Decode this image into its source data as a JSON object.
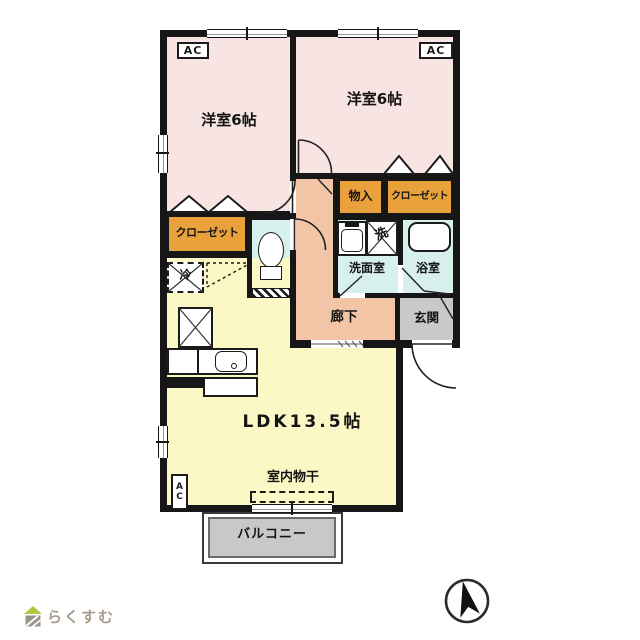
{
  "palette": {
    "wall": "#161616",
    "bedroom_pink": "#f8e4e2",
    "closet_orange": "#e9a13b",
    "water_cyan": "#d7f0ee",
    "ldk_yellow": "#fbf8c5",
    "hall_salmon": "#f3c5a7",
    "entrance_gray": "#c9c9c9",
    "balcony_gray": "#c8c8c8",
    "logo_text_gray": "#a79a8d",
    "logo_roof_green": "#b3c83f"
  },
  "rooms": {
    "bedroom1": "洋室6帖",
    "bedroom2": "洋室6帖",
    "storage": "物入",
    "closet_right": "クローゼット",
    "closet_left": "クローゼット",
    "washroom": "洗面室",
    "bathroom": "浴室",
    "hallway": "廊下",
    "entrance": "玄関",
    "ldk": "LDK13.5帖",
    "indoor_drying": "室内物干",
    "balcony": "バルコニー"
  },
  "fixtures": {
    "ac_label": "AC",
    "fridge_label": "冷",
    "washer_label": "洗"
  },
  "footer": {
    "brand": "らくすむ"
  }
}
